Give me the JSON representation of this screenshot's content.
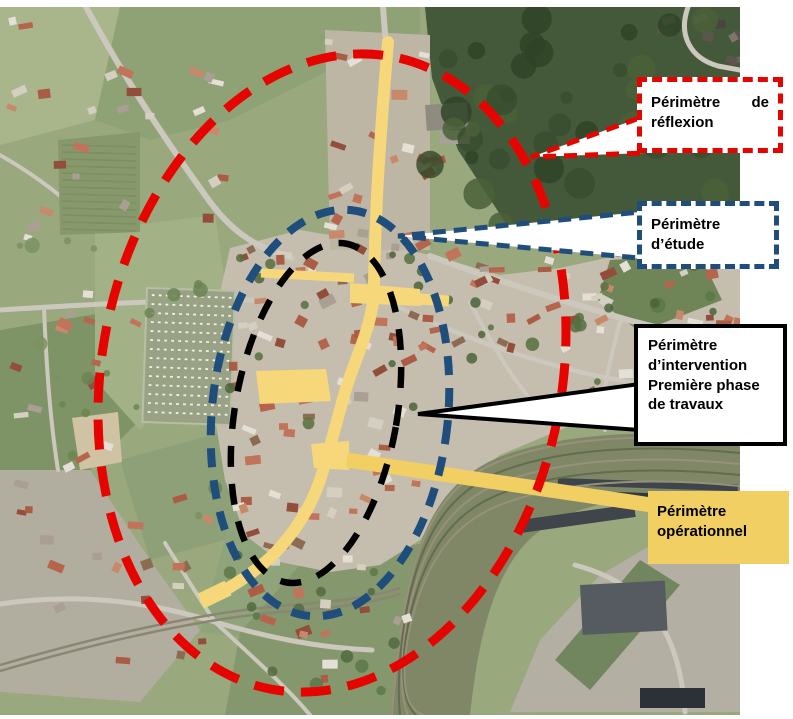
{
  "legend": {
    "reflexion": {
      "label": "Périmètre de réflexion",
      "style": "dashed",
      "color": "#e60400"
    },
    "etude": {
      "label": "Périmètre d’étude",
      "style": "dashed",
      "color": "#1f4e7c"
    },
    "intervention": {
      "label": "Périmètre d’intervention Première phase de travaux",
      "style": "solid",
      "color": "#000000"
    },
    "operationnel": {
      "label": "Périmètre opérationnel",
      "style": "filled",
      "color": "#f2cf63"
    }
  },
  "colors": {
    "reflexion_red": "#e60400",
    "etude_blue": "#1f4e7c",
    "intervention_black": "#000000",
    "operational_road_yellow": "#f6d87a",
    "operational_label_yellow": "#f2cf63"
  }
}
